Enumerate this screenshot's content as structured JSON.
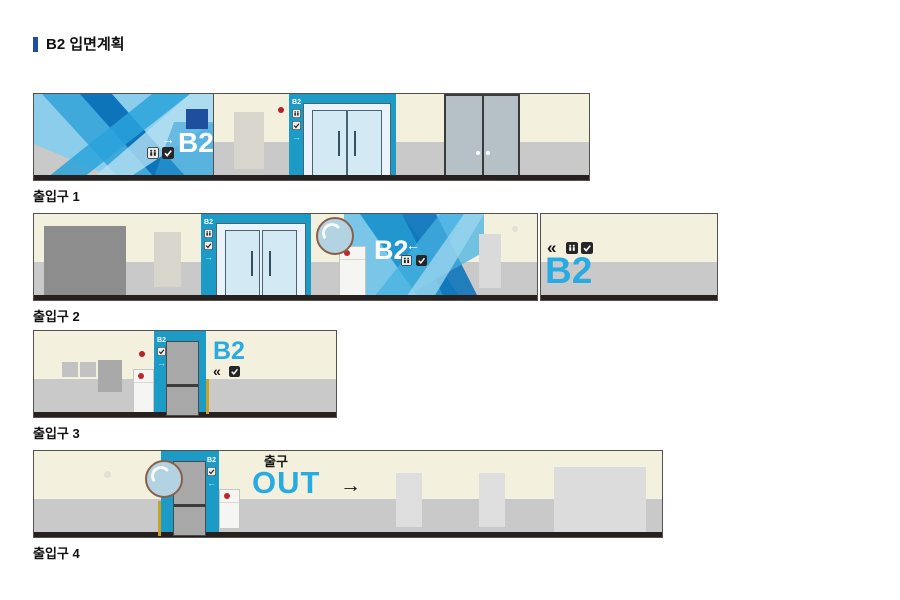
{
  "title": "B2 입면계획",
  "colors": {
    "accent_navy": "#1d4f9e",
    "sign_cyan": "#29abe2",
    "elevator_teal": "#1b9bc6",
    "wall_cream": "#f3f0de",
    "wall_gray": "#c9c9c9",
    "baseline_dark": "#26211f",
    "alert_red": "#b82025",
    "kickplate_yellow": "#c9a227"
  },
  "strips": [
    {
      "caption": "출입구 1",
      "pillar_sign": {
        "text": "B2",
        "arrow": "→",
        "icons": [
          "elevator-icon",
          "transfer-check-icon"
        ]
      },
      "pattern_sign": {
        "text": "B2",
        "arrow": "→",
        "icons": [
          "elevator-icon",
          "transfer-check-icon"
        ]
      }
    },
    {
      "caption": "출입구 2",
      "pillar_sign": {
        "text": "B2",
        "arrow": "→",
        "icons": [
          "elevator-icon",
          "transfer-check-icon"
        ]
      },
      "pattern_sign": {
        "text": "B2",
        "arrow": "←",
        "icons": [
          "elevator-icon",
          "transfer-check-icon"
        ]
      },
      "wall_sign": {
        "chevrons": "«",
        "text": "B2",
        "icons": [
          "elevator-icon",
          "transfer-check-icon"
        ]
      }
    },
    {
      "caption": "출입구 3",
      "pillar_sign": {
        "text": "B2",
        "arrow": "→",
        "icons": [
          "transfer-check-icon"
        ]
      },
      "wall_sign": {
        "text": "B2",
        "chevrons": "«",
        "icons": [
          "transfer-check-icon"
        ]
      }
    },
    {
      "caption": "출입구 4",
      "pillar_sign": {
        "text": "B2",
        "arrow": "←",
        "icons": [
          "transfer-check-icon"
        ]
      },
      "exit_sign": {
        "korean": "출구",
        "english": "OUT",
        "arrow": "→"
      }
    }
  ]
}
